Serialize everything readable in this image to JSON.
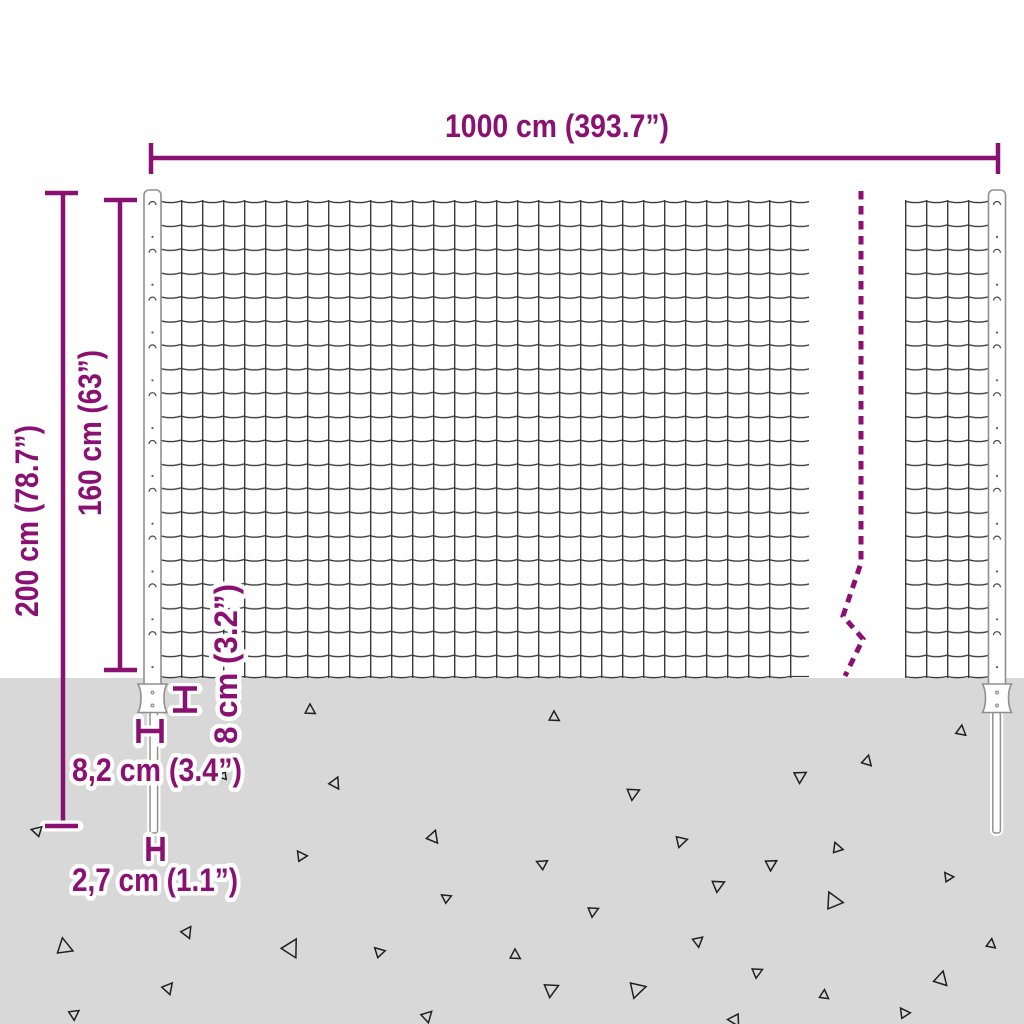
{
  "diagram": {
    "type": "product-dimension-diagram",
    "subject": "wire-mesh-fence-with-posts",
    "labels": {
      "width": "1000 cm (393.7”)",
      "total_height": "200 cm (78.7”)",
      "fence_height": "160 cm (63”)",
      "anchor_depth": "8 cm (3.2”)",
      "post_width": "8,2 cm (3.4”)",
      "spike_width": "2,7 cm (1.1”)"
    },
    "colors": {
      "accent": "#8a1072",
      "ground": "#d8d8d8",
      "wire": "#3a3a3a",
      "post_outline": "#8f8f8f",
      "debris": "#1f1f1f"
    },
    "triangles": [
      [
        310,
        710,
        11,
        0
      ],
      [
        335,
        783,
        12,
        25
      ],
      [
        223,
        776,
        9,
        -100
      ],
      [
        37,
        831,
        11,
        -75
      ],
      [
        301,
        856,
        11,
        -35
      ],
      [
        64,
        947,
        17,
        -10
      ],
      [
        187,
        932,
        12,
        35
      ],
      [
        433,
        837,
        13,
        20
      ],
      [
        446,
        898,
        10,
        -55
      ],
      [
        291,
        948,
        19,
        30
      ],
      [
        379,
        952,
        11,
        -45
      ],
      [
        168,
        988,
        12,
        40
      ],
      [
        74,
        1014,
        11,
        55
      ],
      [
        427,
        1016,
        12,
        45
      ],
      [
        554,
        717,
        11,
        0
      ],
      [
        961,
        731,
        11,
        8
      ],
      [
        867,
        761,
        11,
        15
      ],
      [
        800,
        776,
        13,
        60
      ],
      [
        633,
        793,
        13,
        65
      ],
      [
        681,
        841,
        12,
        75
      ],
      [
        542,
        864,
        11,
        -65
      ],
      [
        771,
        864,
        12,
        60
      ],
      [
        837,
        848,
        11,
        -20
      ],
      [
        718,
        885,
        13,
        65
      ],
      [
        833,
        901,
        18,
        -25
      ],
      [
        948,
        877,
        10,
        -35
      ],
      [
        593,
        911,
        11,
        65
      ],
      [
        698,
        941,
        11,
        50
      ],
      [
        551,
        989,
        15,
        65
      ],
      [
        637,
        989,
        17,
        75
      ],
      [
        757,
        972,
        11,
        65
      ],
      [
        824,
        995,
        10,
        5
      ],
      [
        904,
        1013,
        11,
        -35
      ],
      [
        941,
        979,
        15,
        15
      ],
      [
        991,
        944,
        10,
        8
      ],
      [
        515,
        955,
        11,
        0
      ],
      [
        735,
        1020,
        13,
        150
      ]
    ]
  }
}
